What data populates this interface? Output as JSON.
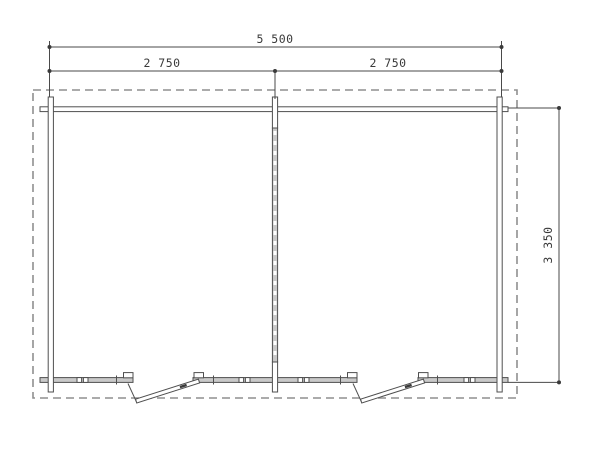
{
  "drawing": {
    "type": "floor-plan",
    "name": "two-room cabin plan view",
    "dims": {
      "overall_width_label": "5 500",
      "bay_left_label": "2 750",
      "bay_right_label": "2 750",
      "depth_label": "3 350"
    },
    "colors": {
      "line": "#4f4f4f",
      "dimension_line": "#4a4a4a",
      "dashed_outline": "#8f8f8f",
      "wall_fill_gray": "#c9c9c9",
      "text": "#3a3a3a",
      "background": "#ffffff"
    }
  }
}
